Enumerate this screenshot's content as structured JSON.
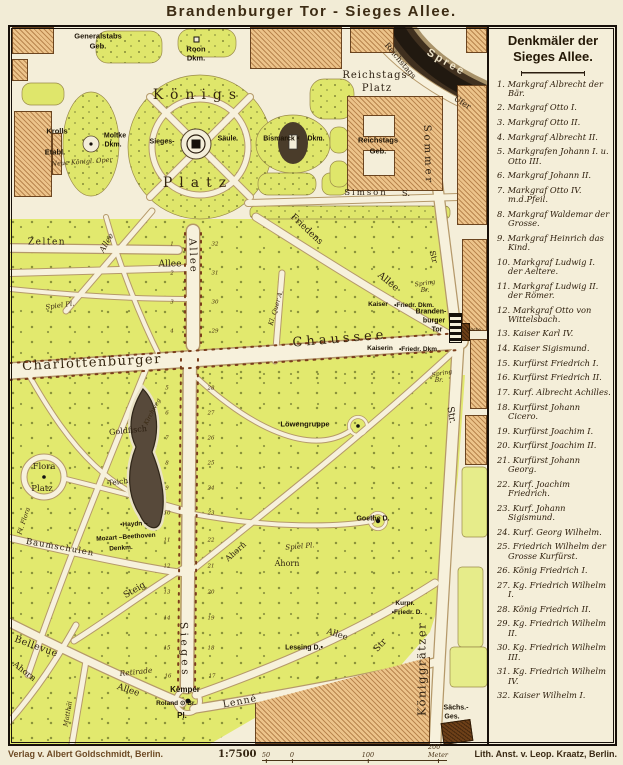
{
  "title": "Brandenburger Tor  -  Sieges Allee.",
  "colors": {
    "paper": "#f4eed9",
    "park_green": "#e2e96e",
    "building_tan": "#ecc38a",
    "building_dark": "#6e4018",
    "river_dark": "#2e2418",
    "frame_black": "#17100a",
    "road_cream": "#f7f1dc",
    "label_ink": "#2b1e10"
  },
  "legend": {
    "title_line1": "Denkmäler der",
    "title_line2": "Sieges Allee.",
    "items": [
      {
        "num": "1.",
        "text": "Markgraf Albrecht der Bär."
      },
      {
        "num": "2.",
        "text": "Markgraf Otto I."
      },
      {
        "num": "3.",
        "text": "Markgraf Otto II."
      },
      {
        "num": "4.",
        "text": "Markgraf Albrecht II."
      },
      {
        "num": "5.",
        "text": "Markgrafen Johann I. u. Otto III."
      },
      {
        "num": "6.",
        "text": "Markgraf Johann II."
      },
      {
        "num": "7.",
        "text": "Markgraf Otto IV. m.d.Pfeil."
      },
      {
        "num": "8.",
        "text": "Markgraf Waldemar der Grosse."
      },
      {
        "num": "9.",
        "text": "Markgraf Heinrich das Kind."
      },
      {
        "num": "10.",
        "text": "Markgraf Ludwig I. der Aeltere."
      },
      {
        "num": "11.",
        "text": "Markgraf Ludwig II. der Römer."
      },
      {
        "num": "12.",
        "text": "Markgraf Otto von Wittelsbach."
      },
      {
        "num": "13.",
        "text": "Kaiser Karl IV."
      },
      {
        "num": "14.",
        "text": "Kaiser Sigismund."
      },
      {
        "num": "15.",
        "text": "Kurfürst Friedrich I."
      },
      {
        "num": "16.",
        "text": "Kurfürst Friedrich II."
      },
      {
        "num": "17.",
        "text": "Kurf. Albrecht Achilles."
      },
      {
        "num": "18.",
        "text": "Kurfürst Johann Cicero."
      },
      {
        "num": "19.",
        "text": "Kurfürst Joachim I."
      },
      {
        "num": "20.",
        "text": "Kurfürst Joachim II."
      },
      {
        "num": "21.",
        "text": "Kurfürst Johann Georg."
      },
      {
        "num": "22.",
        "text": "Kurf. Joachim Friedrich."
      },
      {
        "num": "23.",
        "text": "Kurf. Johann Sigismund."
      },
      {
        "num": "24.",
        "text": "Kurf. Georg Wilhelm."
      },
      {
        "num": "25.",
        "text": "Friedrich Wilhelm der Grosse Kurfürst."
      },
      {
        "num": "26.",
        "text": "König Friedrich I."
      },
      {
        "num": "27.",
        "text": "Kg. Friedrich Wilhelm I."
      },
      {
        "num": "28.",
        "text": "König Friedrich II."
      },
      {
        "num": "29.",
        "text": "Kg. Friedrich Wilhelm II."
      },
      {
        "num": "30.",
        "text": "Kg. Friedrich Wilhelm III."
      },
      {
        "num": "31.",
        "text": "Kg. Friedrich Wilhelm IV."
      },
      {
        "num": "32.",
        "text": "Kaiser Wilhelm I."
      }
    ]
  },
  "footer": {
    "publisher": "Verlag v. Albert Goldschmidt, Berlin.",
    "scale": "1:7500",
    "scale_ticks": [
      {
        "t": "50",
        "x": 4
      },
      {
        "t": "0",
        "x": 30
      },
      {
        "t": "100",
        "x": 106
      },
      {
        "t": "200 Meter",
        "x": 176
      }
    ],
    "lithographer": "Lith. Anst. v. Leop. Kraatz, Berlin."
  },
  "map": {
    "labels": [
      {
        "t": "Generalstabs",
        "x": 88,
        "y": 9,
        "s": 7.5,
        "c": "bsans"
      },
      {
        "t": "Geb.",
        "x": 88,
        "y": 19,
        "s": 7.5,
        "c": "bsans"
      },
      {
        "t": "Roon",
        "x": 186,
        "y": 22,
        "s": 7.5,
        "c": "bsans"
      },
      {
        "t": "Dkm.",
        "x": 186,
        "y": 31,
        "s": 7.5,
        "c": "bsans"
      },
      {
        "t": "Königs",
        "x": 188,
        "y": 68,
        "s": 14,
        "c": "big",
        "sp": 7
      },
      {
        "t": "Platz",
        "x": 188,
        "y": 156,
        "s": 14,
        "c": "big",
        "sp": 7
      },
      {
        "t": "Krolls",
        "x": 47,
        "y": 104,
        "s": 7.5,
        "c": "bsans"
      },
      {
        "t": "Etabl.",
        "x": 45,
        "y": 125,
        "s": 7.5,
        "c": "bsans"
      },
      {
        "t": "Neue Königl. Oper",
        "x": 72,
        "y": 135,
        "s": 6.5,
        "c": "it",
        "r": -4
      },
      {
        "t": "Moltke",
        "x": 105,
        "y": 109,
        "s": 7,
        "c": "bsans"
      },
      {
        "t": "Dkm.",
        "x": 103,
        "y": 118,
        "s": 7,
        "c": "bsans"
      },
      {
        "t": "Sieges-",
        "x": 152,
        "y": 115,
        "s": 7,
        "c": "bsans"
      },
      {
        "t": "Säule",
        "x": 217,
        "y": 112,
        "s": 7,
        "c": "bsans"
      },
      {
        "t": "Reichstags",
        "x": 365,
        "y": 49,
        "s": 10,
        "c": "med",
        "sp": 1
      },
      {
        "t": "Platz",
        "x": 367,
        "y": 62,
        "s": 10,
        "c": "med",
        "sp": 1
      },
      {
        "t": "Spree",
        "x": 436,
        "y": 36,
        "s": 11,
        "c": "spree",
        "r": 30,
        "sp": 2.5
      },
      {
        "t": "Reichstags",
        "x": 390,
        "y": 34,
        "s": 8,
        "c": "med",
        "r": 50
      },
      {
        "t": "Ufer",
        "x": 452,
        "y": 76,
        "s": 8,
        "c": "med",
        "r": 32
      },
      {
        "t": "Sommer",
        "x": 417,
        "y": 128,
        "s": 10,
        "c": "med",
        "r": 88,
        "sp": 3
      },
      {
        "t": "Str",
        "x": 423,
        "y": 230,
        "s": 8,
        "c": "med",
        "r": 75
      },
      {
        "t": "Bismarck",
        "x": 269,
        "y": 112,
        "s": 7,
        "c": "bsans"
      },
      {
        "t": "×",
        "x": 288,
        "y": 112,
        "s": 6,
        "c": "bsans"
      },
      {
        "t": "Dkm.",
        "x": 306,
        "y": 112,
        "s": 7,
        "c": "bsans"
      },
      {
        "t": "Reichstags",
        "x": 368,
        "y": 113,
        "s": 7.5,
        "c": "bsans"
      },
      {
        "t": "Geb.",
        "x": 368,
        "y": 124,
        "s": 7.5,
        "c": "bsans"
      },
      {
        "t": "Simson",
        "x": 356,
        "y": 166,
        "s": 8.5,
        "c": "med",
        "sp": 2
      },
      {
        "t": "S.",
        "x": 396,
        "y": 167,
        "s": 8.5,
        "c": "med"
      },
      {
        "t": "Zelten",
        "x": 37,
        "y": 216,
        "s": 9,
        "c": "med",
        "sp": 1.5
      },
      {
        "t": "Allee",
        "x": 97,
        "y": 216,
        "s": 8,
        "c": "it",
        "r": -60
      },
      {
        "t": "Allee",
        "x": 160,
        "y": 238,
        "s": 9,
        "c": "med"
      },
      {
        "t": "Allee",
        "x": 182,
        "y": 229,
        "s": 10,
        "c": "med",
        "r": 88,
        "sp": 2
      },
      {
        "t": "Friedens",
        "x": 296,
        "y": 203,
        "s": 9,
        "c": "med",
        "r": 43
      },
      {
        "t": "Allee",
        "x": 378,
        "y": 255,
        "s": 9.5,
        "c": "med",
        "r": 40
      },
      {
        "t": "Kl. Quer A.",
        "x": 266,
        "y": 281,
        "s": 6.5,
        "c": "it",
        "r": -73
      },
      {
        "t": "Spiel Pl.",
        "x": 50,
        "y": 279,
        "s": 7,
        "c": "it",
        "r": -8
      },
      {
        "t": "Spring",
        "x": 415,
        "y": 257,
        "s": 6,
        "c": "it",
        "r": -8
      },
      {
        "t": "Br.",
        "x": 415,
        "y": 264,
        "s": 6,
        "c": "it"
      },
      {
        "t": "Kaiser",
        "x": 368,
        "y": 278,
        "s": 6.5,
        "c": "bsans"
      },
      {
        "t": "•Friedr. Dkm.",
        "x": 404,
        "y": 279,
        "s": 6.5,
        "c": "bsans"
      },
      {
        "t": "Branden-",
        "x": 421,
        "y": 285,
        "s": 7,
        "c": "bsans"
      },
      {
        "t": "burger",
        "x": 424,
        "y": 294,
        "s": 7,
        "c": "bsans"
      },
      {
        "t": "Tor",
        "x": 427,
        "y": 303,
        "s": 7,
        "c": "bsans"
      },
      {
        "t": "Wache",
        "x": 464,
        "y": 303,
        "s": 4.5,
        "c": "tiny"
      },
      {
        "t": "Chaussee",
        "x": 330,
        "y": 312,
        "s": 13,
        "c": "big",
        "sp": 4,
        "r": -5
      },
      {
        "t": "Charlottenburger",
        "x": 82,
        "y": 336,
        "s": 13,
        "c": "big",
        "sp": 1.5,
        "r": -3
      },
      {
        "t": "Kaiserin",
        "x": 370,
        "y": 322,
        "s": 6.5,
        "c": "bsans"
      },
      {
        "t": "•Friedr. Dkm",
        "x": 408,
        "y": 323,
        "s": 6.5,
        "c": "bsans"
      },
      {
        "t": "Spring",
        "x": 432,
        "y": 347,
        "s": 6,
        "c": "it",
        "r": -10
      },
      {
        "t": "Br.",
        "x": 429,
        "y": 354,
        "s": 6,
        "c": "it"
      },
      {
        "t": "Str.",
        "x": 441,
        "y": 388,
        "s": 9.5,
        "c": "med",
        "r": 80
      },
      {
        "t": "Flora",
        "x": 34,
        "y": 440,
        "s": 8.5,
        "c": "med"
      },
      {
        "t": "Platz",
        "x": 32,
        "y": 462,
        "s": 8.5,
        "c": "med"
      },
      {
        "t": "Goldfisch",
        "x": 118,
        "y": 404,
        "s": 8,
        "c": "med",
        "r": -6
      },
      {
        "t": "Teich",
        "x": 108,
        "y": 455,
        "s": 7.5,
        "c": "med",
        "r": -8
      },
      {
        "t": "Kirchweg",
        "x": 143,
        "y": 385,
        "s": 6,
        "c": "it",
        "r": -62
      },
      {
        "t": "Löwengruppe",
        "x": 295,
        "y": 397,
        "s": 7.5,
        "c": "bsans"
      },
      {
        "t": "Goethe D.",
        "x": 363,
        "y": 492,
        "s": 7,
        "c": "bsans"
      },
      {
        "t": "•Haydn –",
        "x": 124,
        "y": 498,
        "s": 6.5,
        "c": "bsans",
        "r": -3
      },
      {
        "t": "Mozart –Beethoven",
        "x": 116,
        "y": 511,
        "s": 6.5,
        "c": "bsans",
        "r": -4
      },
      {
        "t": "Denkm.",
        "x": 111,
        "y": 522,
        "s": 6.5,
        "c": "bsans",
        "r": -4
      },
      {
        "t": "Baumschulen",
        "x": 50,
        "y": 521,
        "s": 8.5,
        "c": "med",
        "r": 10,
        "sp": 1
      },
      {
        "t": "Fl. Flora",
        "x": 14,
        "y": 494,
        "s": 6.5,
        "c": "it",
        "r": -72
      },
      {
        "t": "Ahorn",
        "x": 226,
        "y": 525,
        "s": 8,
        "c": "med",
        "r": -42
      },
      {
        "t": "Ahorn",
        "x": 277,
        "y": 537,
        "s": 8,
        "c": "med"
      },
      {
        "t": "Spiel Pl.",
        "x": 290,
        "y": 520,
        "s": 7,
        "c": "it",
        "r": -5
      },
      {
        "t": "Steig",
        "x": 125,
        "y": 564,
        "s": 9,
        "c": "med",
        "r": -30
      },
      {
        "t": "Sieges",
        "x": 174,
        "y": 623,
        "s": 10.5,
        "c": "med",
        "r": 88,
        "sp": 3.5
      },
      {
        "t": "Bellevue",
        "x": 26,
        "y": 620,
        "s": 9.5,
        "c": "med",
        "r": 20,
        "sp": 0.5
      },
      {
        "t": "Ahorn",
        "x": 14,
        "y": 645,
        "s": 8.5,
        "c": "med",
        "r": 38
      },
      {
        "t": "Allee",
        "x": 118,
        "y": 664,
        "s": 9,
        "c": "med",
        "r": 18
      },
      {
        "t": "Matthäi",
        "x": 58,
        "y": 687,
        "s": 6.5,
        "c": "it",
        "r": -80
      },
      {
        "t": "Retirade",
        "x": 126,
        "y": 645,
        "s": 7.5,
        "c": "it",
        "r": -6
      },
      {
        "t": "Kemper",
        "x": 175,
        "y": 663,
        "s": 8,
        "c": "bsans"
      },
      {
        "t": "Roland ⊙ Br.",
        "x": 166,
        "y": 677,
        "s": 6.5,
        "c": "bsans"
      },
      {
        "t": "Pl.",
        "x": 172,
        "y": 689,
        "s": 8,
        "c": "bsans"
      },
      {
        "t": "Lenné",
        "x": 230,
        "y": 675,
        "s": 9.5,
        "c": "med",
        "r": -11,
        "sp": 1
      },
      {
        "t": "Lessing D.•",
        "x": 294,
        "y": 621,
        "s": 7,
        "c": "bsans"
      },
      {
        "t": "Allee",
        "x": 327,
        "y": 608,
        "s": 8.5,
        "c": "med",
        "r": 18
      },
      {
        "t": "Kurpr.",
        "x": 395,
        "y": 577,
        "s": 6.5,
        "c": "bsans"
      },
      {
        "t": "•Friedr. D.",
        "x": 397,
        "y": 586,
        "s": 6.5,
        "c": "bsans"
      },
      {
        "t": "Str",
        "x": 371,
        "y": 619,
        "s": 9,
        "c": "med",
        "r": -48
      },
      {
        "t": "Königgrätzer",
        "x": 412,
        "y": 642,
        "s": 11.5,
        "c": "med",
        "r": -90,
        "sp": 1.5
      },
      {
        "t": "Sächs.-",
        "x": 446,
        "y": 681,
        "s": 7,
        "c": "bsans"
      },
      {
        "t": "Ges.",
        "x": 442,
        "y": 690,
        "s": 7,
        "c": "bsans"
      }
    ],
    "monument_numbers": [
      {
        "n": "1",
        "x": 162,
        "y": 218
      },
      {
        "n": "2",
        "x": 162,
        "y": 247
      },
      {
        "n": "3",
        "x": 162,
        "y": 276
      },
      {
        "n": "4",
        "x": 162,
        "y": 305
      },
      {
        "n": "5",
        "x": 157,
        "y": 362
      },
      {
        "n": "6",
        "x": 157,
        "y": 387
      },
      {
        "n": "7",
        "x": 157,
        "y": 412
      },
      {
        "n": "8",
        "x": 157,
        "y": 437
      },
      {
        "n": "9",
        "x": 157,
        "y": 462
      },
      {
        "n": "10",
        "x": 157,
        "y": 487
      },
      {
        "n": "11",
        "x": 157,
        "y": 514
      },
      {
        "n": "12",
        "x": 157,
        "y": 540
      },
      {
        "n": "13",
        "x": 157,
        "y": 566
      },
      {
        "n": "14",
        "x": 157,
        "y": 592
      },
      {
        "n": "15",
        "x": 157,
        "y": 622
      },
      {
        "n": "16",
        "x": 158,
        "y": 650
      },
      {
        "n": "32",
        "x": 205,
        "y": 218
      },
      {
        "n": "31",
        "x": 205,
        "y": 247
      },
      {
        "n": "30",
        "x": 205,
        "y": 276
      },
      {
        "n": "29",
        "x": 205,
        "y": 305
      },
      {
        "n": "28",
        "x": 201,
        "y": 362
      },
      {
        "n": "27",
        "x": 201,
        "y": 387
      },
      {
        "n": "26",
        "x": 201,
        "y": 412
      },
      {
        "n": "25",
        "x": 201,
        "y": 437
      },
      {
        "n": "24",
        "x": 201,
        "y": 462
      },
      {
        "n": "23",
        "x": 201,
        "y": 487
      },
      {
        "n": "22",
        "x": 201,
        "y": 514
      },
      {
        "n": "21",
        "x": 201,
        "y": 540
      },
      {
        "n": "20",
        "x": 201,
        "y": 566
      },
      {
        "n": "19",
        "x": 201,
        "y": 592
      },
      {
        "n": "18",
        "x": 201,
        "y": 622
      },
      {
        "n": "17",
        "x": 202,
        "y": 650
      }
    ]
  }
}
